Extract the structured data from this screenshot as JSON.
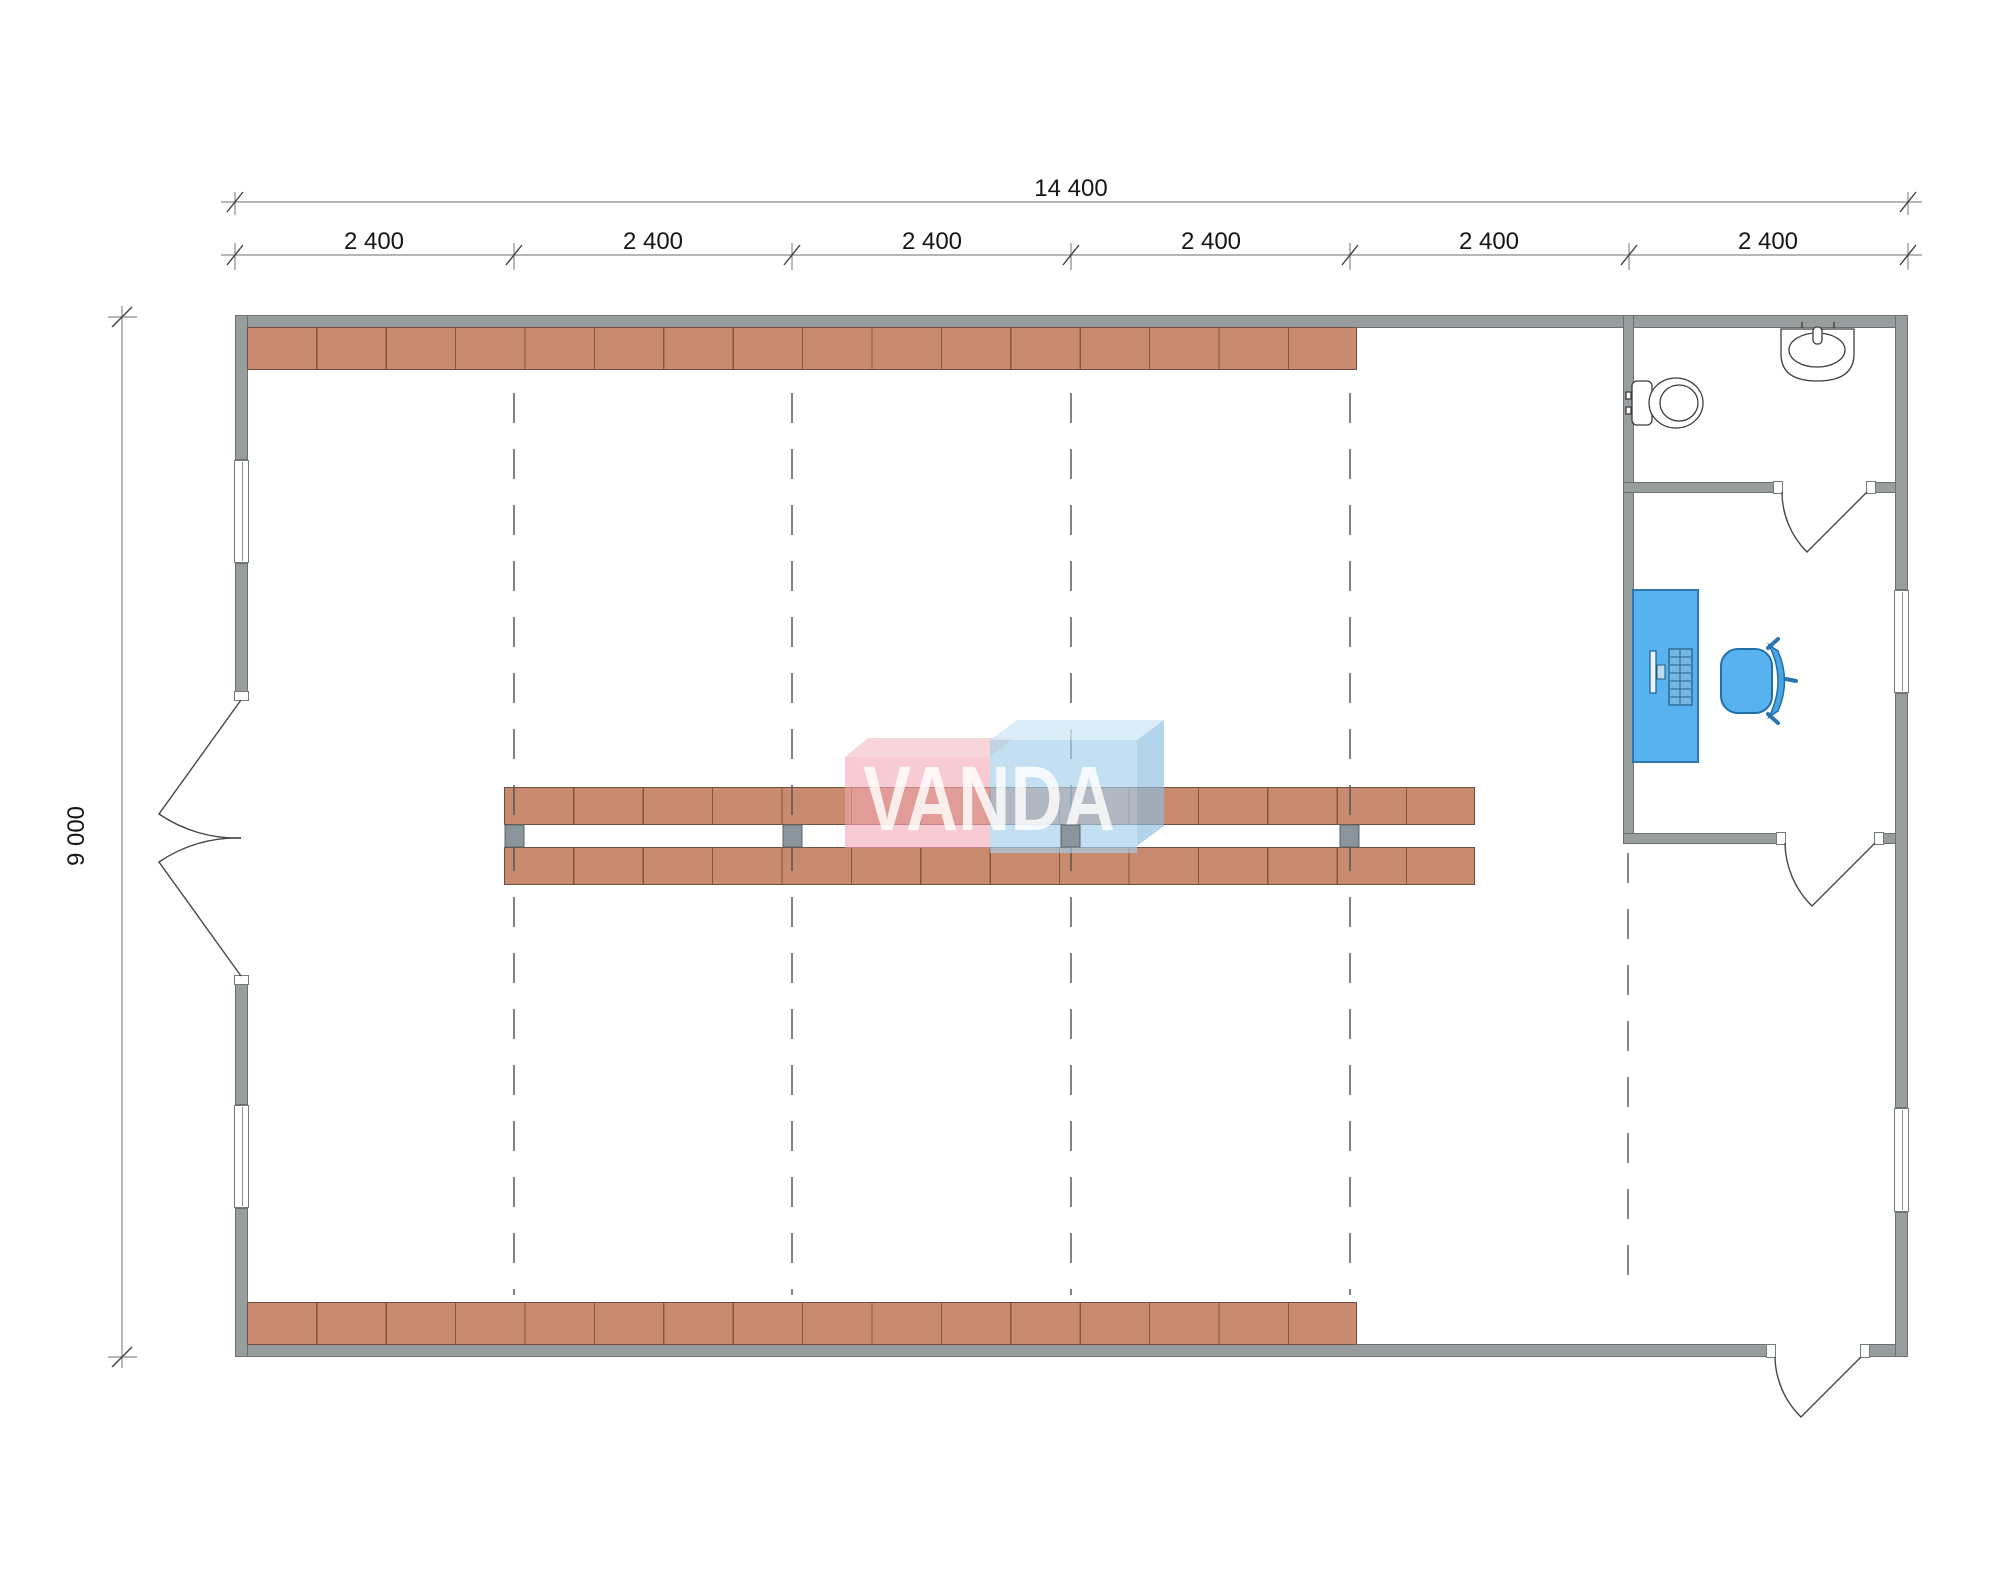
{
  "drawing": {
    "watermark": "VANDA",
    "dimensions": {
      "total_width": "14 400",
      "total_height": "9 000",
      "bays": [
        "2 400",
        "2 400",
        "2 400",
        "2 400",
        "2 400",
        "2 400"
      ]
    },
    "colors": {
      "wall": "#989e9e",
      "shelf": "#c98b6f",
      "connector": "#8a959c",
      "furniture": "#57b2ef",
      "furniture_stroke": "#2b77ae",
      "watermark_pink": "rgba(242,168,178,0.60)",
      "watermark_pink_top": "rgba(246,199,206,0.75)",
      "watermark_blue": "rgba(164,208,236,0.66)",
      "watermark_blue_top": "rgba(208,232,246,0.78)",
      "watermark_blue_side": "rgba(140,190,225,0.66)"
    },
    "shelving": {
      "top_wall_units": 16,
      "bottom_wall_units": 16,
      "center_rows": 2,
      "center_row_units": 14,
      "center_connectors": 4
    },
    "fixtures": [
      "toilet",
      "sink",
      "desk",
      "computer",
      "office-chair"
    ],
    "openings": [
      "double-entry-door-left",
      "bathroom-door",
      "office-door",
      "exit-door-bottom",
      "window-left-upper",
      "window-left-lower",
      "window-right-office",
      "window-right-lower"
    ]
  }
}
